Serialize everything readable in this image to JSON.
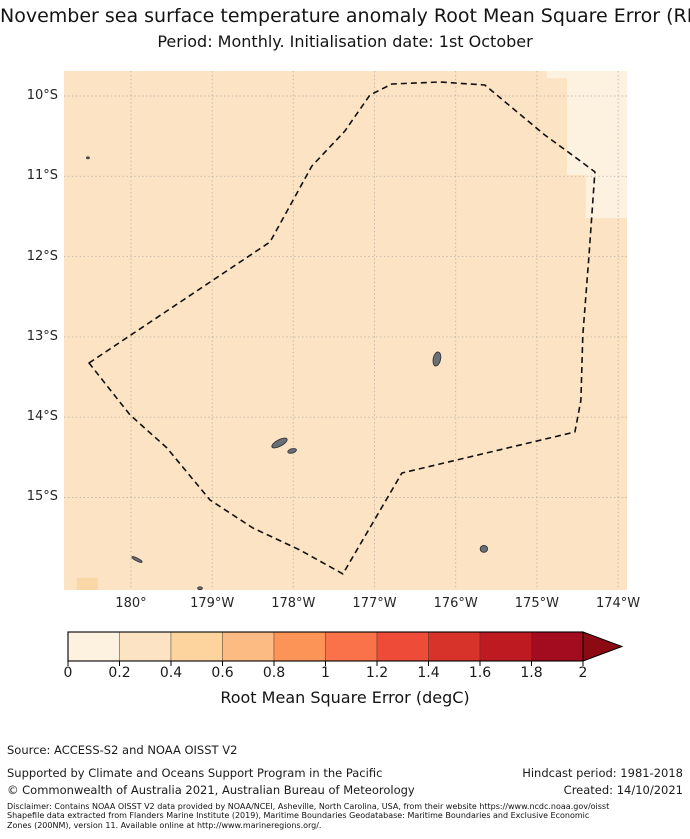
{
  "title": {
    "line1": "November sea surface temperature anomaly Root Mean Square Error (RMSE)",
    "line2": "Period: Monthly. Initialisation date: 1st October"
  },
  "footer": {
    "source": "Source: ACCESS-S2 and NOAA OISST V2",
    "supported": "Supported by Climate and Oceans Support Program in the Pacific",
    "copyright": "© Commonwealth of Australia 2021, Australian Bureau of Meteorology",
    "hindcast": "Hindcast period: 1981-2018",
    "created": "Created: 14/10/2021",
    "disclaimer_line1": "Disclaimer: Contains NOAA OISST V2 data provided by NOAA/NCEI, Asheville, North Carolina, USA, from their website https://www.ncdc.noaa.gov/oisst",
    "disclaimer_line2": "Shapefile data extracted from Flanders Marine Institute (2019), Maritime Boundaries Geodatabase: Maritime Boundaries and Exclusive Economic",
    "disclaimer_line3": "Zones (200NM), version 11. Available online at http://www.marineregions.org/."
  },
  "chart_data": {
    "type": "heatmap",
    "title": "November sea surface temperature anomaly Root Mean Square Error (RMSE)",
    "subtitle": "Period: Monthly. Initialisation date: 1st October",
    "x_tick_labels": [
      "180°",
      "179°W",
      "178°W",
      "177°W",
      "176°W",
      "175°W",
      "174°W"
    ],
    "y_tick_labels": [
      "10°S",
      "11°S",
      "12°S",
      "13°S",
      "14°S",
      "15°S"
    ],
    "extent": {
      "x_rel": [
        -0.825,
        6.11
      ],
      "lat_south": [
        9.689,
        16.152
      ]
    },
    "grid": {
      "on": true,
      "color": "#8d8d8d",
      "style": "dotted"
    },
    "field": {
      "background_color": "#fce3c3",
      "background_rmse_bin": "0.2-0.4",
      "patches": [
        {
          "rmse_bin": "0-0.2",
          "color": "#fdf1e0",
          "x": [
            5.12,
            6.11
          ],
          "lat": [
            9.689,
            9.78
          ]
        },
        {
          "rmse_bin": "0-0.2",
          "color": "#fdf1e0",
          "x": [
            5.37,
            6.11
          ],
          "lat": [
            9.689,
            10.984
          ]
        },
        {
          "rmse_bin": "0-0.2",
          "color": "#fdf1e0",
          "x": [
            5.6,
            6.11
          ],
          "lat": [
            10.984,
            11.52
          ]
        },
        {
          "rmse_bin": "0.4-0.6",
          "color": "#fbd7a7",
          "x": [
            -0.67,
            -0.41
          ],
          "lat": [
            16.0,
            16.152
          ]
        }
      ]
    },
    "eez_boundary_style": "dashed",
    "eez_boundary": [
      [
        -0.517,
        13.325
      ],
      [
        1.712,
        11.818
      ],
      [
        2.167,
        10.984
      ],
      [
        2.229,
        10.872
      ],
      [
        2.635,
        10.436
      ],
      [
        2.943,
        9.988
      ],
      [
        3.214,
        9.851
      ],
      [
        3.805,
        9.826
      ],
      [
        4.359,
        9.863
      ],
      [
        5.098,
        10.486
      ],
      [
        5.468,
        10.76
      ],
      [
        5.714,
        10.946
      ],
      [
        5.64,
        12.02
      ],
      [
        5.566,
        12.98
      ],
      [
        5.542,
        13.79
      ],
      [
        5.468,
        14.184
      ],
      [
        3.337,
        14.695
      ],
      [
        2.611,
        15.952
      ],
      [
        2.081,
        15.654
      ],
      [
        1.502,
        15.38
      ],
      [
        0.973,
        15.031
      ],
      [
        0.443,
        14.383
      ],
      [
        -0.012,
        13.972
      ]
    ],
    "islands": [
      {
        "x": -0.53,
        "lat": 10.77,
        "rx": 0.018,
        "ry": 0.012,
        "rot": 0
      },
      {
        "x": 1.829,
        "lat": 14.321,
        "rx": 0.105,
        "ry": 0.04,
        "rot": -28
      },
      {
        "x": 1.985,
        "lat": 14.42,
        "rx": 0.055,
        "ry": 0.026,
        "rot": -15
      },
      {
        "x": 3.768,
        "lat": 13.275,
        "rx": 0.045,
        "ry": 0.088,
        "rot": 12
      },
      {
        "x": 0.074,
        "lat": 15.772,
        "rx": 0.07,
        "ry": 0.018,
        "rot": 27
      },
      {
        "x": 0.85,
        "lat": 16.13,
        "rx": 0.03,
        "ry": 0.018,
        "rot": 0
      },
      {
        "x": 4.347,
        "lat": 15.64,
        "rx": 0.045,
        "ry": 0.042,
        "rot": 0
      }
    ],
    "island_color": "#6b6f77",
    "colorbar": {
      "label": "Root Mean Square Error (degC)",
      "tick_labels": [
        "0",
        "0.2",
        "0.4",
        "0.6",
        "0.8",
        "1",
        "1.2",
        "1.4",
        "1.6",
        "1.8",
        "2"
      ],
      "bin_colors": [
        "#fdf1e0",
        "#fce3c3",
        "#fdd49e",
        "#fdbb84",
        "#fc9357",
        "#f97249",
        "#ee4c38",
        "#d8332a",
        "#bd1a21",
        "#a30c1e"
      ],
      "extend_max_color": "#8b0a13",
      "range": [
        0,
        2
      ]
    }
  }
}
